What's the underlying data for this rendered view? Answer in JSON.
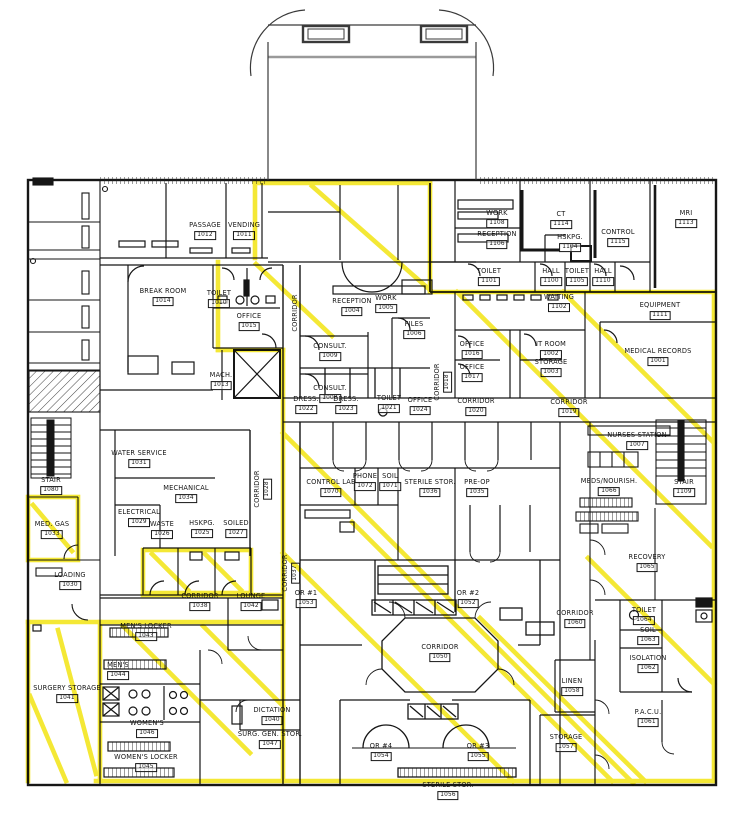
{
  "drawing": {
    "type": "architectural-floor-plan",
    "highlight_color": "#F2E412",
    "wall_color": "#161616",
    "background": "#FFFFFF"
  },
  "rooms": [
    {
      "label": "PASSAGE",
      "number": "1012",
      "x": 205,
      "y": 231
    },
    {
      "label": "VENDING",
      "number": "1011",
      "x": 244,
      "y": 231
    },
    {
      "label": "BREAK ROOM",
      "number": "1014",
      "x": 163,
      "y": 297
    },
    {
      "label": "TOILET",
      "number": "1010",
      "x": 219,
      "y": 299
    },
    {
      "label": "OFFICE",
      "number": "1015",
      "x": 249,
      "y": 322
    },
    {
      "label": "MACH.",
      "number": "1013",
      "x": 221,
      "y": 381
    },
    {
      "label": "CORRIDOR",
      "x": 296,
      "y": 313,
      "vertical": true
    },
    {
      "label": "RECEPTION",
      "number": "1004",
      "x": 352,
      "y": 307
    },
    {
      "label": "WORK",
      "number": "1005",
      "x": 386,
      "y": 304
    },
    {
      "label": "FILES",
      "number": "1006",
      "x": 414,
      "y": 330
    },
    {
      "label": "CONSULT.",
      "number": "1009",
      "x": 330,
      "y": 352
    },
    {
      "label": "CONSULT.",
      "number": "1008",
      "x": 330,
      "y": 394
    },
    {
      "label": "CORRIDOR",
      "number": "1018",
      "x": 443,
      "y": 382,
      "vertical": true
    },
    {
      "label": "WORK",
      "number": "1108",
      "x": 497,
      "y": 219
    },
    {
      "label": "CT",
      "number": "1114",
      "x": 561,
      "y": 220
    },
    {
      "label": "HSKPG.",
      "number": "1104",
      "x": 570,
      "y": 243
    },
    {
      "label": "CONTROL",
      "number": "1115",
      "x": 618,
      "y": 238
    },
    {
      "label": "MRI",
      "number": "1113",
      "x": 686,
      "y": 219
    },
    {
      "label": "RECEPTION",
      "number": "1106",
      "x": 497,
      "y": 240
    },
    {
      "label": "TOILET",
      "number": "1101",
      "x": 489,
      "y": 277
    },
    {
      "label": "HALL",
      "number": "1100",
      "x": 551,
      "y": 277
    },
    {
      "label": "TOILET",
      "number": "1105",
      "x": 577,
      "y": 277
    },
    {
      "label": "HALL",
      "number": "1110",
      "x": 603,
      "y": 277
    },
    {
      "label": "WAITING",
      "number": "1102",
      "x": 559,
      "y": 303
    },
    {
      "label": "EQUIPMENT",
      "number": "1111",
      "x": 660,
      "y": 311
    },
    {
      "label": "OFFICE",
      "number": "1016",
      "x": 472,
      "y": 350
    },
    {
      "label": "OFFICE",
      "number": "1017",
      "x": 472,
      "y": 373
    },
    {
      "label": "IT ROOM",
      "number": "1002",
      "x": 551,
      "y": 350
    },
    {
      "label": "STORAGE",
      "number": "1003",
      "x": 551,
      "y": 368
    },
    {
      "label": "MEDICAL RECORDS",
      "number": "1001",
      "x": 658,
      "y": 357
    },
    {
      "label": "DRESS.",
      "number": "1022",
      "x": 306,
      "y": 405
    },
    {
      "label": "DRESS.",
      "number": "1023",
      "x": 346,
      "y": 405
    },
    {
      "label": "TOILET",
      "number": "1021",
      "x": 389,
      "y": 404
    },
    {
      "label": "OFFICE",
      "number": "1024",
      "x": 420,
      "y": 406
    },
    {
      "label": "CORRIDOR",
      "number": "1020",
      "x": 476,
      "y": 407
    },
    {
      "label": "CORRIDOR",
      "number": "1019",
      "x": 569,
      "y": 408
    },
    {
      "label": "NURSES STATION",
      "number": "1007",
      "x": 637,
      "y": 441
    },
    {
      "label": "STAIR",
      "number": "1109",
      "x": 684,
      "y": 488
    },
    {
      "label": "STAIR",
      "number": "1080",
      "x": 51,
      "y": 486
    },
    {
      "label": "WATER SERVICE",
      "number": "1031",
      "x": 139,
      "y": 459
    },
    {
      "label": "MECHANICAL",
      "number": "1034",
      "x": 186,
      "y": 494
    },
    {
      "label": "ELECTRICAL",
      "number": "1029",
      "x": 139,
      "y": 518
    },
    {
      "label": "WASTE",
      "number": "1026",
      "x": 162,
      "y": 530
    },
    {
      "label": "HSKPG.",
      "number": "1025",
      "x": 202,
      "y": 529
    },
    {
      "label": "SOILED",
      "number": "1027",
      "x": 236,
      "y": 529
    },
    {
      "label": "MED. GAS",
      "number": "1033",
      "x": 52,
      "y": 530
    },
    {
      "label": "LOADING",
      "number": "1030",
      "x": 70,
      "y": 581
    },
    {
      "label": "CORRIDOR",
      "number": "1028",
      "x": 263,
      "y": 489,
      "vertical": true
    },
    {
      "label": "CORRIDOR",
      "number": "1037",
      "x": 291,
      "y": 573,
      "vertical": true
    },
    {
      "label": "CONTROL LAB",
      "number": "1070",
      "x": 331,
      "y": 488
    },
    {
      "label": "PHONE",
      "number": "1072",
      "x": 365,
      "y": 482
    },
    {
      "label": "SOIL",
      "number": "1071",
      "x": 390,
      "y": 482
    },
    {
      "label": "STERILE STOR.",
      "number": "1036",
      "x": 430,
      "y": 488
    },
    {
      "label": "PRE-OP",
      "number": "1035",
      "x": 477,
      "y": 488
    },
    {
      "label": "MEDS/NOURISH.",
      "number": "1066",
      "x": 609,
      "y": 487
    },
    {
      "label": "RECOVERY",
      "number": "1065",
      "x": 647,
      "y": 563
    },
    {
      "label": "CORRIDOR",
      "number": "1060",
      "x": 575,
      "y": 619
    },
    {
      "label": "TOILET",
      "number": "1064",
      "x": 644,
      "y": 616
    },
    {
      "label": "SOIL",
      "number": "1063",
      "x": 648,
      "y": 636
    },
    {
      "label": "ISOLATION",
      "number": "1062",
      "x": 648,
      "y": 664
    },
    {
      "label": "OR #1",
      "number": "1053",
      "x": 306,
      "y": 599
    },
    {
      "label": "OR #2",
      "number": "1052",
      "x": 468,
      "y": 599
    },
    {
      "label": "CORRIDOR",
      "number": "1050",
      "x": 440,
      "y": 653
    },
    {
      "label": "CORRIDOR",
      "number": "1038",
      "x": 200,
      "y": 602
    },
    {
      "label": "LOUNGE",
      "number": "1042",
      "x": 251,
      "y": 602
    },
    {
      "label": "MEN'S LOCKER",
      "number": "1043",
      "x": 146,
      "y": 632
    },
    {
      "label": "MEN'S",
      "number": "1044",
      "x": 118,
      "y": 671
    },
    {
      "label": "WOMEN'S",
      "number": "1046",
      "x": 147,
      "y": 729
    },
    {
      "label": "WOMEN'S LOCKER",
      "number": "1045",
      "x": 146,
      "y": 763
    },
    {
      "label": "SURGERY STORAGE",
      "number": "1041",
      "x": 67,
      "y": 694
    },
    {
      "label": "DICTATION",
      "number": "1040",
      "x": 272,
      "y": 716
    },
    {
      "label": "SURG. GEN. STOR.",
      "number": "1047",
      "x": 270,
      "y": 740
    },
    {
      "label": "LINEN",
      "number": "1058",
      "x": 572,
      "y": 687
    },
    {
      "label": "STORAGE",
      "number": "1057",
      "x": 566,
      "y": 743
    },
    {
      "label": "P.A.C.U.",
      "number": "1061",
      "x": 648,
      "y": 718
    },
    {
      "label": "OR #4",
      "number": "1054",
      "x": 381,
      "y": 752
    },
    {
      "label": "OR #3",
      "number": "1055",
      "x": 478,
      "y": 752
    },
    {
      "label": "STERILE STOR.",
      "number": "1056",
      "x": 448,
      "y": 791
    }
  ]
}
